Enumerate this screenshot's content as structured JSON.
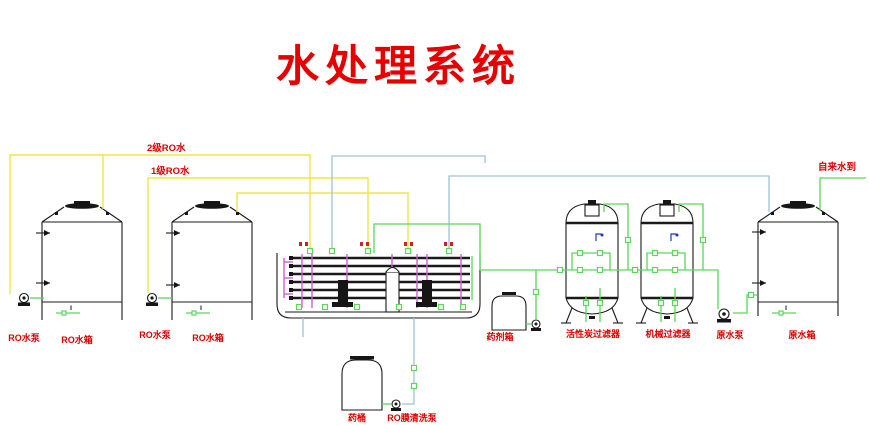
{
  "title": "水处理系统",
  "labels": {
    "second_stage_ro_water": "2级RO水",
    "first_stage_ro_water": "1级RO水",
    "tap_water_inlet": "自来水到",
    "ro_pump_left": "RO水泵",
    "ro_tank_left": "RO水箱",
    "ro_pump_mid": "RO水泵",
    "ro_tank_mid": "RO水箱",
    "chemical_barrel": "药桶",
    "ro_membrane_cleaning_pump": "RO膜清洗泵",
    "dosing_tank": "药剂箱",
    "activated_carbon_filter": "活性炭过滤器",
    "mechanical_filter": "机械过滤器",
    "raw_water_pump": "原水泵",
    "raw_water_tank": "原水箱",
    "level_gauge_mark": "Ⅱ"
  },
  "colors": {
    "title_red": "#e60000",
    "label_red": "#dd0000",
    "pipe_yellow": "#f0e545",
    "pipe_green": "#5cd65c",
    "pipe_cyan": "#9fc3d5",
    "pipe_magenta": "#cc5fcc",
    "outline_black": "#1a1a1a",
    "gauge_blue": "#2233bb"
  }
}
